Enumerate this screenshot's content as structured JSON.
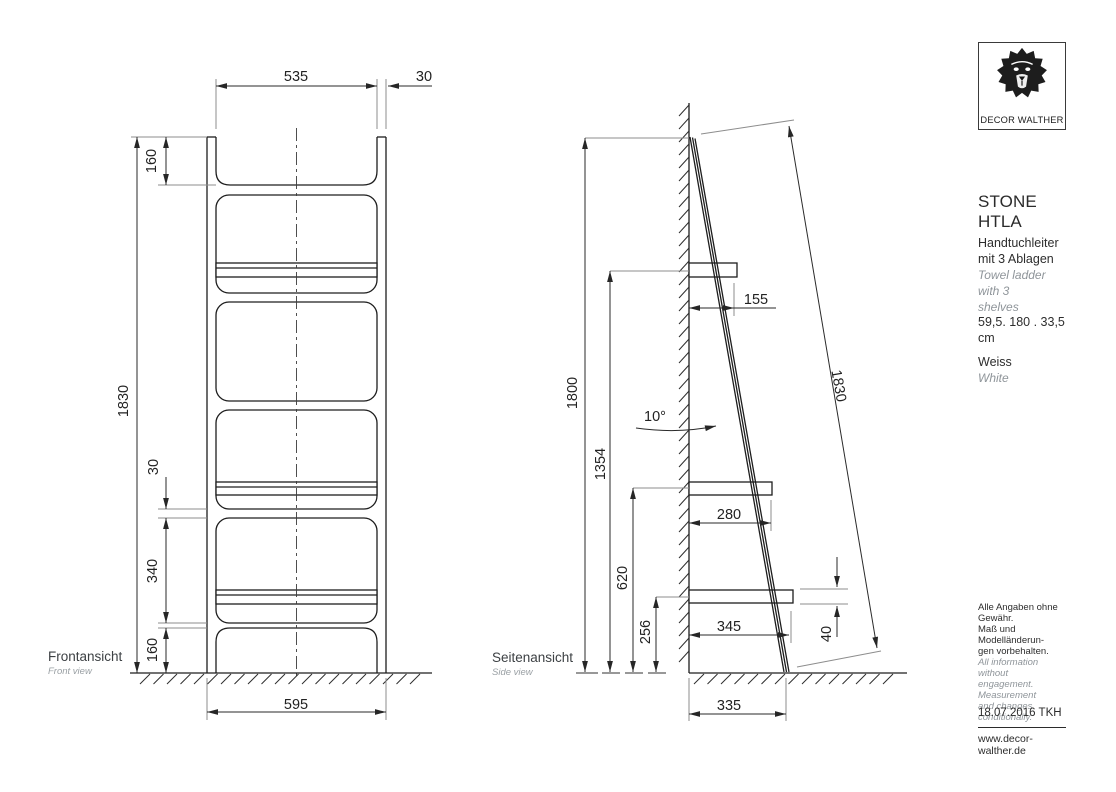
{
  "front_view": {
    "label": "Frontansicht",
    "label_en": "Front view",
    "dims": {
      "inner_width": "535",
      "rail_width": "30",
      "top_section": "160",
      "total_height": "1830",
      "rung_gap": "30",
      "shelf_spacing": "340",
      "leg_height": "160",
      "outer_width": "595"
    }
  },
  "side_view": {
    "label": "Seitenansicht",
    "label_en": "Side view",
    "dims": {
      "wall_height": "1800",
      "shelf1_from_floor": "1354",
      "shelf2_from_floor": "620",
      "shelf3_from_floor": "256",
      "shelf1_depth": "155",
      "tilt_angle": "10°",
      "shelf2_depth": "280",
      "shelf3_depth": "345",
      "shelf_thickness": "40",
      "ladder_length": "1830",
      "floor_depth": "335"
    }
  },
  "info_panel": {
    "brand": "DECOR WALTHER",
    "logo_icon": "lion-head",
    "product_name": "STONE HTLA",
    "description_de": [
      "Handtuchleiter",
      "mit 3 Ablagen"
    ],
    "description_en": [
      "Towel ladder with 3",
      "shelves"
    ],
    "size": "59,5. 180 . 33,5",
    "size_unit": "cm",
    "color_de": "Weiss",
    "color_en": "White",
    "legal_de": [
      "Alle Angaben ohne Gewähr.",
      "Maß und Modelländerun-",
      "gen vorbehalten."
    ],
    "legal_en": [
      "All information without",
      "engagement. Measurement",
      "and changes conditionally."
    ],
    "date_author": "18.07.2016 TKH",
    "website": "www.decor-walther.de"
  },
  "colors": {
    "line": "#1d1d1d",
    "dimension": "#2a2a2a",
    "extension": "#8d8d8d",
    "muted_text": "#979da1",
    "text": "#2f3337"
  }
}
